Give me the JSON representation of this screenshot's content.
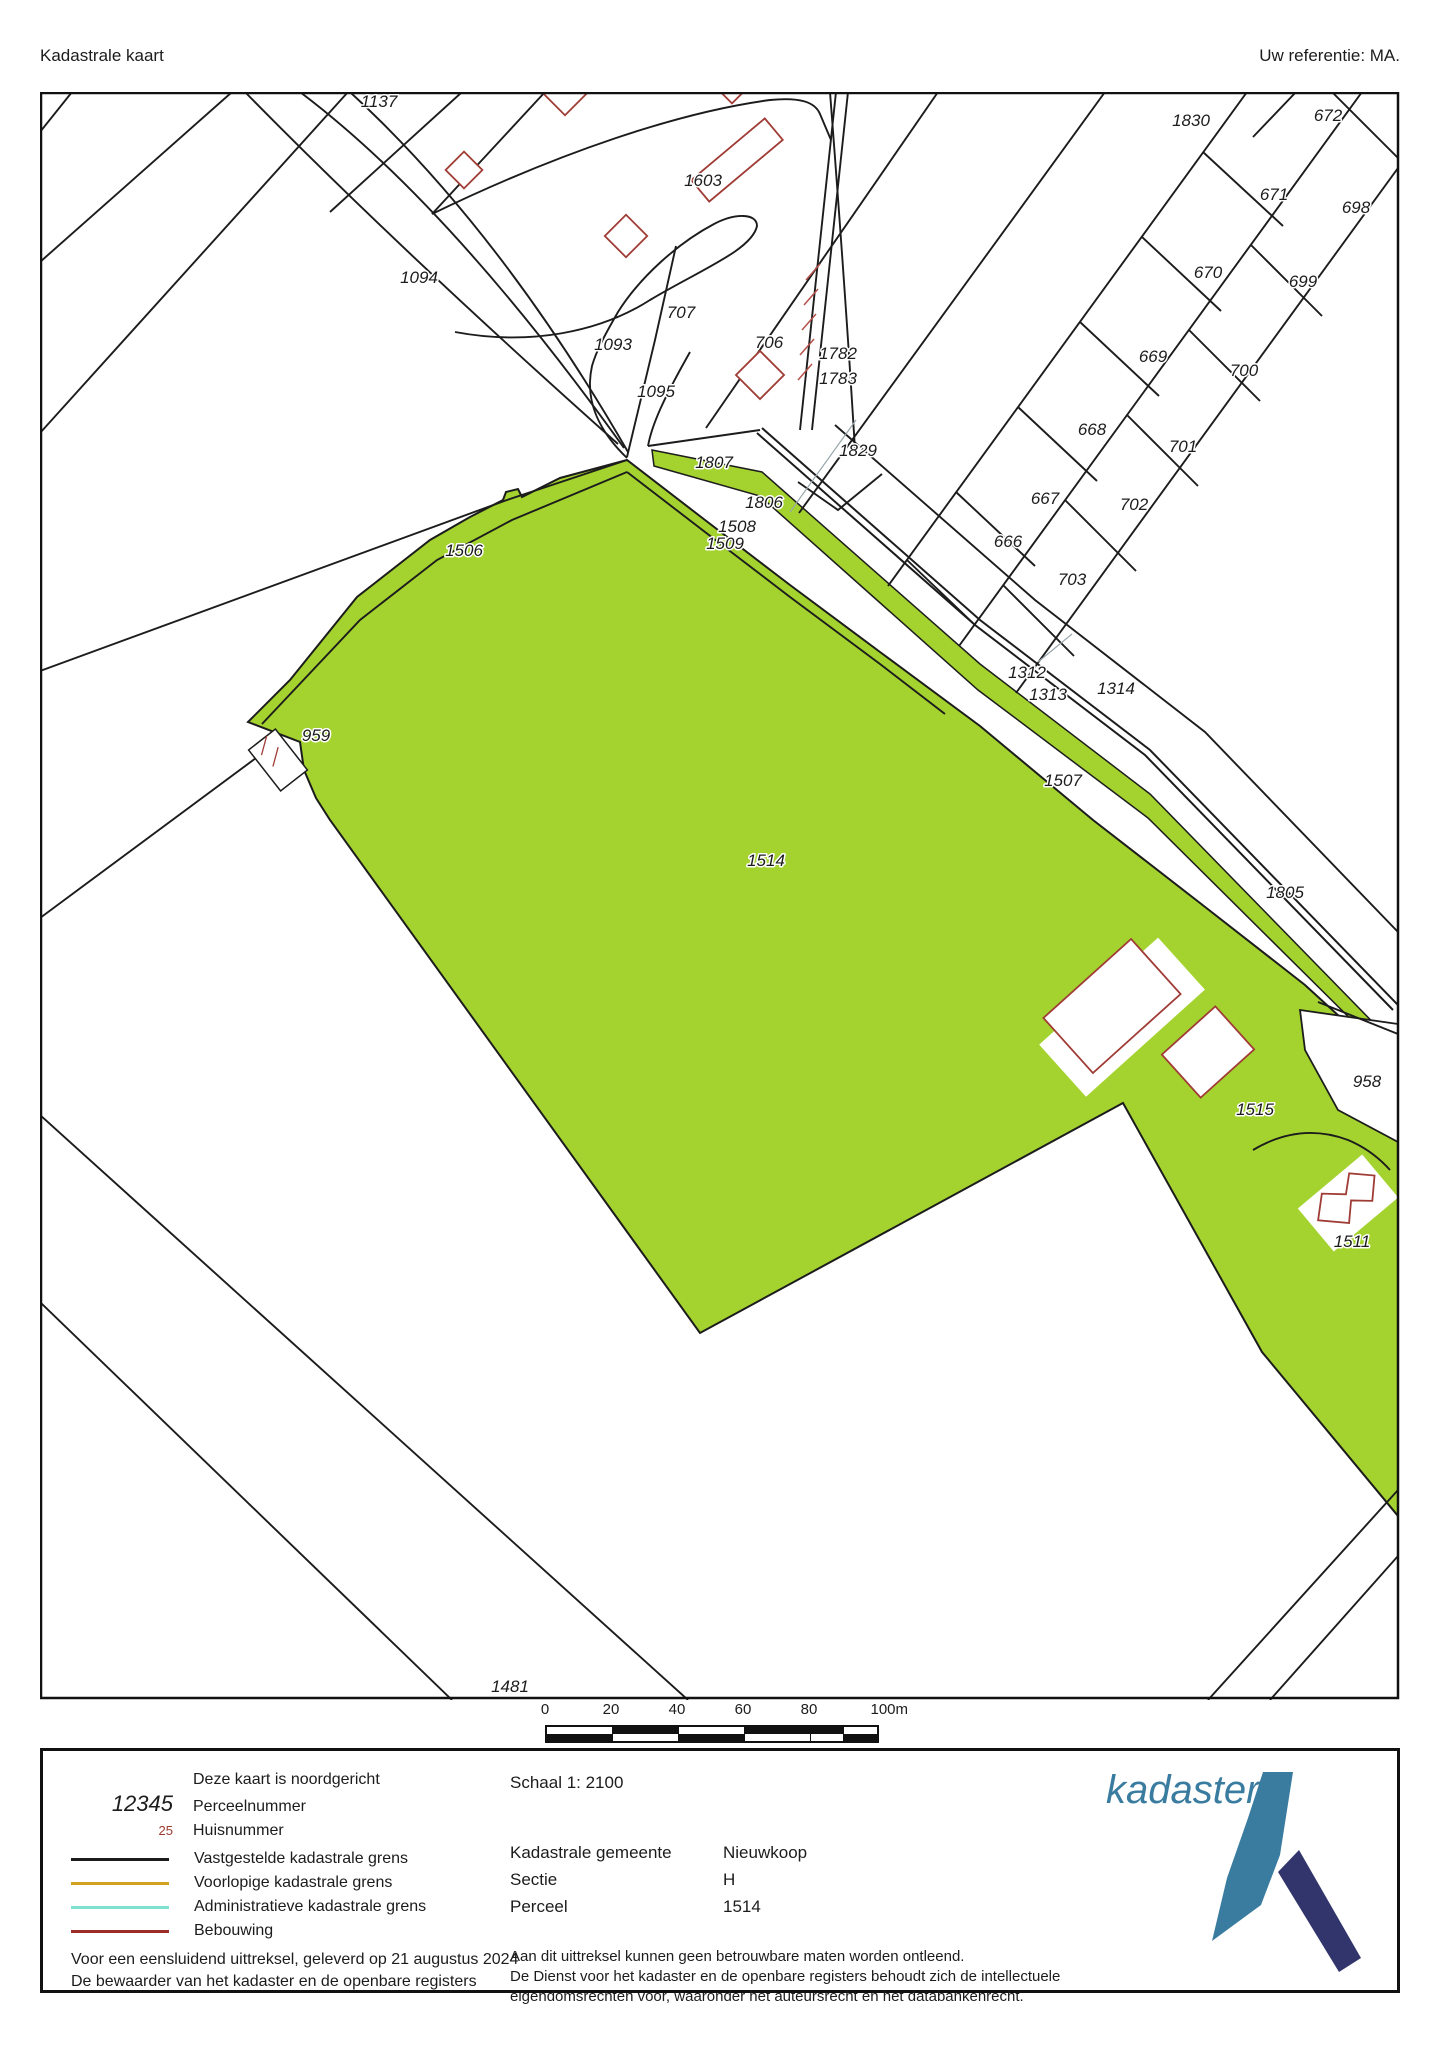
{
  "header": {
    "title": "Kadastrale kaart",
    "reference": "Uw referentie: MA."
  },
  "map": {
    "parcels": [
      {
        "id": "1137",
        "x": 379,
        "y": 107
      },
      {
        "id": "1603",
        "x": 703,
        "y": 186
      },
      {
        "id": "1830",
        "x": 1191,
        "y": 126
      },
      {
        "id": "672",
        "x": 1328,
        "y": 121
      },
      {
        "id": "671",
        "x": 1274,
        "y": 200
      },
      {
        "id": "698",
        "x": 1356,
        "y": 213
      },
      {
        "id": "670",
        "x": 1208,
        "y": 278
      },
      {
        "id": "699",
        "x": 1303,
        "y": 287
      },
      {
        "id": "1094",
        "x": 419,
        "y": 283
      },
      {
        "id": "707",
        "x": 681,
        "y": 318
      },
      {
        "id": "706",
        "x": 769,
        "y": 348
      },
      {
        "id": "1782",
        "x": 838,
        "y": 359
      },
      {
        "id": "1783",
        "x": 838,
        "y": 384
      },
      {
        "id": "669",
        "x": 1153,
        "y": 362
      },
      {
        "id": "700",
        "x": 1244,
        "y": 376
      },
      {
        "id": "1093",
        "x": 613,
        "y": 350
      },
      {
        "id": "1095",
        "x": 656,
        "y": 397
      },
      {
        "id": "668",
        "x": 1092,
        "y": 435
      },
      {
        "id": "701",
        "x": 1183,
        "y": 452
      },
      {
        "id": "667",
        "x": 1045,
        "y": 504
      },
      {
        "id": "702",
        "x": 1134,
        "y": 510
      },
      {
        "id": "666",
        "x": 1008,
        "y": 547
      },
      {
        "id": "703",
        "x": 1072,
        "y": 585
      },
      {
        "id": "1829",
        "x": 858,
        "y": 456
      },
      {
        "id": "1807",
        "x": 714,
        "y": 468
      },
      {
        "id": "1806",
        "x": 764,
        "y": 508
      },
      {
        "id": "1508",
        "x": 737,
        "y": 532
      },
      {
        "id": "1509",
        "x": 725,
        "y": 549
      },
      {
        "id": "1506",
        "x": 464,
        "y": 556
      },
      {
        "id": "1312",
        "x": 1027,
        "y": 678
      },
      {
        "id": "1313",
        "x": 1048,
        "y": 700
      },
      {
        "id": "1314",
        "x": 1116,
        "y": 694
      },
      {
        "id": "959",
        "x": 316,
        "y": 741
      },
      {
        "id": "1507",
        "x": 1063,
        "y": 786
      },
      {
        "id": "1514",
        "x": 766,
        "y": 866
      },
      {
        "id": "1805",
        "x": 1285,
        "y": 898
      },
      {
        "id": "958",
        "x": 1367,
        "y": 1087
      },
      {
        "id": "1515",
        "x": 1255,
        "y": 1115
      },
      {
        "id": "1511",
        "x": 1352,
        "y": 1247
      },
      {
        "id": "1481",
        "x": 510,
        "y": 1692
      }
    ]
  },
  "scalebar": {
    "ticks": [
      "0",
      "20",
      "40",
      "60",
      "80",
      "100m"
    ]
  },
  "legend": {
    "north_note": "Deze kaart is noordgericht",
    "parcel_sample": "12345",
    "parcel_label": "Perceelnummer",
    "house_sample": "25",
    "house_label": "Huisnummer",
    "lines": [
      {
        "label": "Vastgestelde kadastrale grens",
        "color": "#1c1c1c"
      },
      {
        "label": "Voorlopige kadastrale grens",
        "color": "#d4a21f"
      },
      {
        "label": "Administratieve kadastrale grens",
        "color": "#7fe0d0"
      },
      {
        "label": "Bebouwing",
        "color": "#9b2d28"
      }
    ]
  },
  "info": {
    "scale": "Schaal 1: 2100",
    "rows": [
      {
        "label": "Kadastrale gemeente",
        "value": "Nieuwkoop"
      },
      {
        "label": "Sectie",
        "value": "H"
      },
      {
        "label": "Perceel",
        "value": "1514"
      }
    ],
    "disclaimer": [
      "Aan dit uittreksel kunnen geen betrouwbare maten worden ontleend.",
      "De Dienst voor het kadaster en de openbare registers behoudt zich de intellectuele",
      "eigendomsrechten voor, waaronder het auteursrecht en het databankenrecht."
    ]
  },
  "footer": {
    "lines": [
      "Voor een eensluidend uittreksel, geleverd op 21 augustus 2024",
      "De bewaarder van het kadaster en de openbare registers"
    ]
  },
  "logo": {
    "text": "kadaster"
  },
  "colors": {
    "parcel_fill": "#a4d32f",
    "boundary": "#1c1c1c",
    "building": "#a03c36",
    "accent_teal": "#3a7ca0",
    "accent_navy": "#31356b"
  }
}
